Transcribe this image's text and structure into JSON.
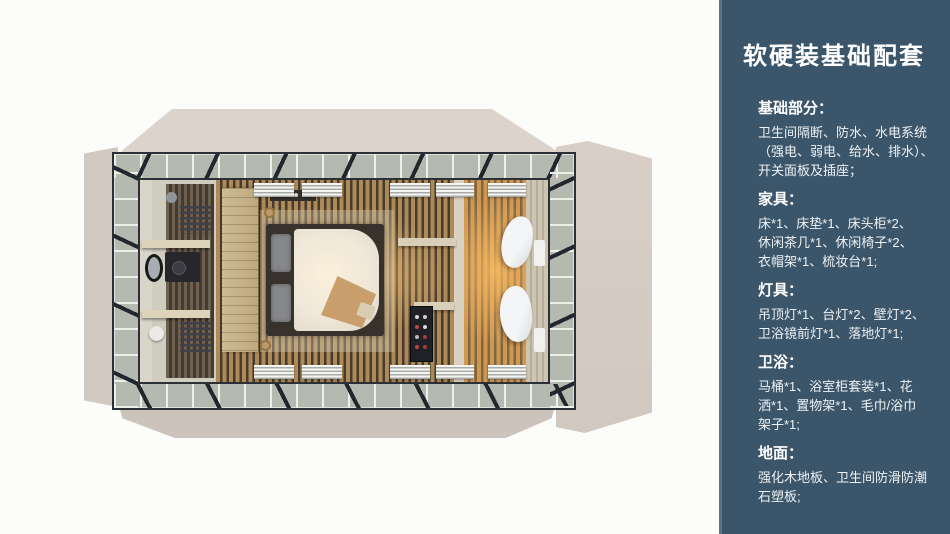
{
  "panel": {
    "title": "软硬装基础配套",
    "background_color": "#3b566a",
    "accent_stripe_color": "#5f7486",
    "text_color": "#ffffff",
    "sections": [
      {
        "heading": "基础部分：",
        "lines": [
          "卫生间隔断、防水、水电系统",
          "（强电、弱电、给水、排水）、",
          "开关面板及插座；"
        ]
      },
      {
        "heading": "家具：",
        "lines": [
          "床*1、床垫*1、床头柜*2、",
          "休闲茶几*1、休闲椅子*2、",
          "衣帽架*1、梳妆台*1;"
        ]
      },
      {
        "heading": "灯具：",
        "lines": [
          "吊顶灯*1、台灯*2、壁灯*2、",
          "卫浴镜前灯*1、落地灯*1;"
        ]
      },
      {
        "heading": "卫浴：",
        "lines": [
          "马桶*1、浴室柜套装*1、花",
          "洒*1、置物架*1、毛巾/浴巾",
          "架子*1;"
        ]
      },
      {
        "heading": "地面：",
        "lines": [
          "强化木地板、卫生间防滑防潮",
          "石塑板;"
        ]
      }
    ]
  },
  "floorplan": {
    "colors": {
      "flap_beige": "#d5cdc5",
      "frame_walkway": "#b5b9af",
      "frame_line": "#2b3036",
      "wood_floor": "#ad8a58",
      "warm_glow": "#e8a55e",
      "bathroom_wall": "#cfccc0",
      "duvet": "#f4ecdb"
    }
  }
}
